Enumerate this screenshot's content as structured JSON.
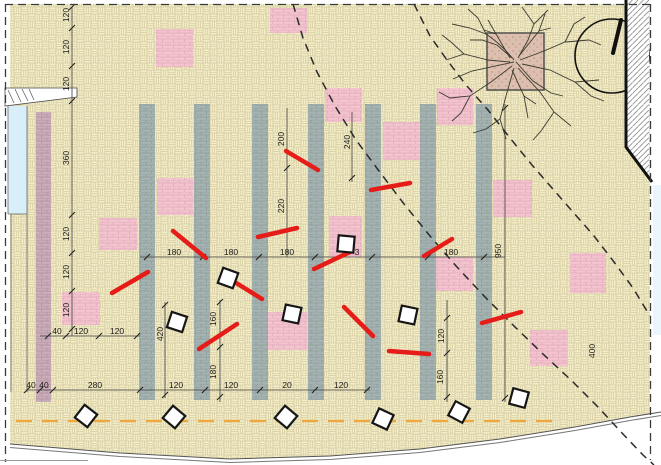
{
  "plan": {
    "canvas": {
      "w": 661,
      "h": 465
    },
    "colors": {
      "paving": "#f2ecc7",
      "paving_line": "#d5cb9e",
      "bar": "#a4b2b1",
      "bar_line": "#8d9d9b",
      "bed": "#f3c3ce",
      "bed_line": "#e1a9ba",
      "mauve": "#c9acb7",
      "mauve_line": "#b2929f",
      "red_mark": "#e51c18",
      "orange": "#f0a83c",
      "blue_margin": "#d8eef8",
      "planter": "#dcbfae"
    },
    "gray_bars": [
      [
        139,
        104
      ],
      [
        194,
        104
      ],
      [
        252,
        104
      ],
      [
        308,
        104
      ],
      [
        365,
        104
      ],
      [
        420,
        104
      ],
      [
        476,
        104
      ]
    ],
    "bar_size": [
      16,
      296
    ],
    "mauve_bar": [
      36,
      112,
      15,
      290
    ],
    "pink_squares": [
      [
        156,
        29,
        37,
        38
      ],
      [
        270,
        8,
        37,
        25
      ],
      [
        325,
        88,
        37,
        34
      ],
      [
        383,
        122,
        37,
        38
      ],
      [
        437,
        88,
        36,
        37
      ],
      [
        493,
        180,
        39,
        37
      ],
      [
        570,
        253,
        36,
        40
      ],
      [
        435,
        257,
        38,
        34
      ],
      [
        530,
        330,
        38,
        36
      ],
      [
        329,
        216,
        33,
        41
      ],
      [
        268,
        312,
        39,
        38
      ],
      [
        157,
        178,
        36,
        37
      ],
      [
        99,
        218,
        38,
        32
      ],
      [
        62,
        292,
        38,
        33
      ]
    ],
    "red_marks": [
      [
        286,
        151,
        318,
        170
      ],
      [
        371,
        190,
        410,
        183
      ],
      [
        112,
        293,
        148,
        272
      ],
      [
        173,
        231,
        206,
        258
      ],
      [
        258,
        237,
        297,
        228
      ],
      [
        314,
        269,
        352,
        251
      ],
      [
        233,
        281,
        262,
        299
      ],
      [
        344,
        307,
        373,
        336
      ],
      [
        199,
        349,
        237,
        324
      ],
      [
        389,
        351,
        429,
        354
      ],
      [
        482,
        323,
        521,
        312
      ],
      [
        424,
        256,
        452,
        239
      ]
    ],
    "diamonds": [
      [
        228,
        278,
        20
      ],
      [
        292,
        314,
        12
      ],
      [
        346,
        244,
        5
      ],
      [
        408,
        315,
        12
      ],
      [
        177,
        322,
        18
      ],
      [
        86,
        416,
        38
      ],
      [
        174,
        417,
        40
      ],
      [
        286,
        417,
        40
      ],
      [
        383,
        419,
        25
      ],
      [
        459,
        412,
        28
      ],
      [
        519,
        398,
        15
      ]
    ],
    "diamond_size": 16,
    "dashed_paths": [
      [
        [
          293,
          4
        ],
        [
          303,
          38
        ],
        [
          317,
          72
        ],
        [
          335,
          106
        ],
        [
          356,
          140
        ],
        [
          379,
          171
        ],
        [
          404,
          204
        ],
        [
          430,
          236
        ],
        [
          457,
          267
        ],
        [
          485,
          297
        ],
        [
          514,
          326
        ],
        [
          543,
          354
        ],
        [
          572,
          381
        ],
        [
          599,
          408
        ],
        [
          622,
          433
        ],
        [
          643,
          455
        ],
        [
          654,
          465
        ]
      ],
      [
        [
          414,
          4
        ],
        [
          430,
          36
        ],
        [
          447,
          60
        ],
        [
          466,
          85
        ],
        [
          488,
          110
        ],
        [
          510,
          138
        ],
        [
          532,
          165
        ],
        [
          552,
          188
        ],
        [
          573,
          212
        ],
        [
          594,
          236
        ],
        [
          614,
          262
        ],
        [
          633,
          288
        ],
        [
          650,
          316
        ]
      ]
    ],
    "orange_line": [
      16,
      421,
      552,
      421
    ],
    "bottom_curve": [
      [
        10,
        444
      ],
      [
        120,
        453
      ],
      [
        230,
        459
      ],
      [
        330,
        456
      ],
      [
        420,
        449
      ],
      [
        500,
        439
      ],
      [
        575,
        427
      ],
      [
        630,
        417
      ],
      [
        661,
        412
      ]
    ],
    "dim_lines": [
      [
        72,
        7,
        72,
        336
      ],
      [
        40,
        336,
        140,
        336
      ],
      [
        140,
        257,
        505,
        257
      ],
      [
        27,
        390,
        370,
        390
      ],
      [
        220,
        300,
        220,
        402
      ],
      [
        165,
        302,
        165,
        398
      ],
      [
        287,
        108,
        287,
        257
      ],
      [
        352,
        112,
        352,
        182
      ],
      [
        447,
        300,
        447,
        402
      ],
      [
        505,
        104,
        505,
        402
      ]
    ],
    "ticks": [
      [
        72,
        7
      ],
      [
        72,
        28
      ],
      [
        72,
        66
      ],
      [
        72,
        101
      ],
      [
        72,
        215
      ],
      [
        72,
        253
      ],
      [
        72,
        291
      ],
      [
        72,
        329
      ],
      [
        48,
        336
      ],
      [
        66,
        336
      ],
      [
        99,
        336
      ],
      [
        137,
        336
      ],
      [
        147,
        257
      ],
      [
        203,
        257
      ],
      [
        259,
        257
      ],
      [
        315,
        257
      ],
      [
        372,
        257
      ],
      [
        428,
        257
      ],
      [
        484,
        257
      ],
      [
        27,
        390
      ],
      [
        40,
        390
      ],
      [
        53,
        390
      ],
      [
        140,
        390
      ],
      [
        205,
        390
      ],
      [
        260,
        390
      ],
      [
        315,
        390
      ],
      [
        367,
        390
      ],
      [
        220,
        302
      ],
      [
        220,
        347
      ],
      [
        220,
        397
      ],
      [
        447,
        318
      ],
      [
        447,
        353
      ],
      [
        447,
        397
      ],
      [
        287,
        168
      ],
      [
        352,
        178
      ],
      [
        505,
        108
      ],
      [
        505,
        398
      ],
      [
        165,
        305
      ],
      [
        165,
        395
      ]
    ],
    "labels_h": [
      [
        57,
        331,
        "40"
      ],
      [
        81,
        331,
        "120"
      ],
      [
        117,
        331,
        "120"
      ],
      [
        174,
        252,
        "180"
      ],
      [
        231,
        252,
        "180"
      ],
      [
        287,
        252,
        "180"
      ],
      [
        357,
        252,
        "3"
      ],
      [
        451,
        252,
        "180"
      ],
      [
        31,
        385,
        "40"
      ],
      [
        44,
        385,
        "40"
      ],
      [
        95,
        385,
        "280"
      ],
      [
        176,
        385,
        "120"
      ],
      [
        231,
        385,
        "120"
      ],
      [
        287,
        385,
        "20"
      ],
      [
        341,
        385,
        "120"
      ]
    ],
    "labels_v": [
      [
        66,
        15,
        "120"
      ],
      [
        66,
        47,
        "120"
      ],
      [
        66,
        84,
        "120"
      ],
      [
        66,
        158,
        "360"
      ],
      [
        66,
        234,
        "120"
      ],
      [
        66,
        272,
        "120"
      ],
      [
        66,
        310,
        "120"
      ],
      [
        160,
        334,
        "420"
      ],
      [
        213,
        319,
        "160"
      ],
      [
        213,
        372,
        "180"
      ],
      [
        281,
        139,
        "200"
      ],
      [
        281,
        206,
        "220"
      ],
      [
        347,
        142,
        "240"
      ],
      [
        441,
        336,
        "120"
      ],
      [
        440,
        377,
        "160"
      ],
      [
        498,
        251,
        "950"
      ],
      [
        592,
        351,
        "400"
      ]
    ],
    "tree": {
      "cx": 516,
      "cy": 62,
      "planter": [
        487,
        33,
        57,
        57
      ]
    },
    "compass": {
      "cx": 612,
      "cy": 56,
      "r": 37,
      "hand": [
        621,
        20,
        613,
        53
      ]
    }
  }
}
